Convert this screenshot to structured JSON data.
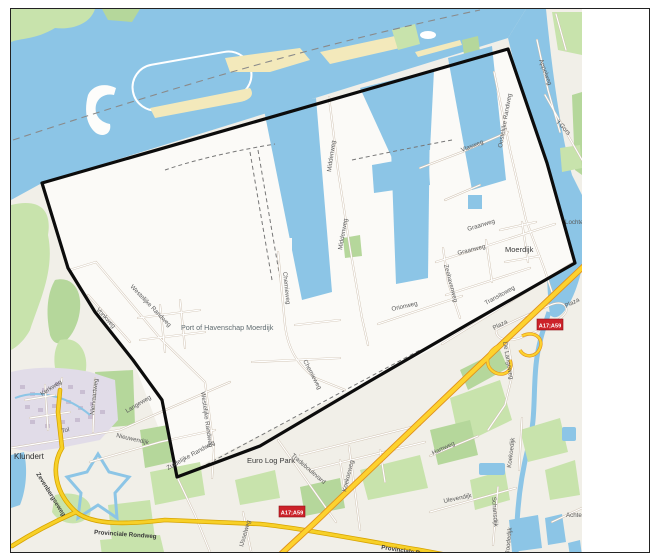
{
  "map": {
    "towns": {
      "klundert": "Klundert",
      "moerdijk": "Moerdijk"
    },
    "areas": {
      "port": "Port of Havenschap Moerdijk",
      "euro_log_park": "Euro Log Park",
      "lochtenburg": "Lochtenburg",
      "achterdijk": "Achterdijk"
    },
    "roads": {
      "vlasweg": "Vlasweg",
      "graanweg": "Graanweg",
      "appelweg": "Appelweg",
      "t_gors": "'t Gors",
      "oostelijke_randweg": "Oostelijke Randweg",
      "westelijke_randweg": "Westelijke Randweg",
      "zuidelijke_randweg": "Zuidelijke Randweg",
      "middenweg": "Middenweg",
      "chemieweg": "Chemieweg",
      "zeehavenweg": "Zeehavenweg",
      "transitoweg": "Transitoweg",
      "orionweg": "Orionweg",
      "plaza": "Plaza",
      "de_langeweg": "De Langeweg",
      "tradeboulevard": "Tradeboulevard",
      "koekoeweg": "Koekoeweg",
      "ijsselweg": "IJsselweg",
      "tol": "Tol",
      "kerkweg": "Kerkweg",
      "nieuwendijk": "Nieuwendijk",
      "langeweg": "Langeweg",
      "niervaartweg": "Niervaartweg",
      "vonkweg": "Vonkweg",
      "zevenbergseweg": "Zevenbergseweg",
      "provinciale_rondweg": "Provinciale Rondweg",
      "ulevendijk": "Ulevendijk",
      "hamweg": "Hamweg",
      "schansdijk": "Schansdijk",
      "koekoedijk": "Koekoedijk",
      "roodedijk": "Roodedijk"
    },
    "shields": {
      "a17_a59": "A17;A59"
    },
    "colors": {
      "water": "#8cc5e6",
      "land": "#f1efe8",
      "port-land": "#fbfaf7",
      "green": "#c8e3ac",
      "green2": "#b5d79b",
      "sand": "#f3e9bb",
      "residential": "#e1dce8",
      "building": "#c9bed2",
      "road-casing": "#cdbfae",
      "yellow": "#f7d028",
      "yellow-casing": "#d8a400",
      "motorway": "#fdd22e",
      "motorway-casing": "#e0911c",
      "boundary": "#0c0c0c",
      "shield": "#cc2229",
      "label": "#5a5a5a"
    }
  }
}
